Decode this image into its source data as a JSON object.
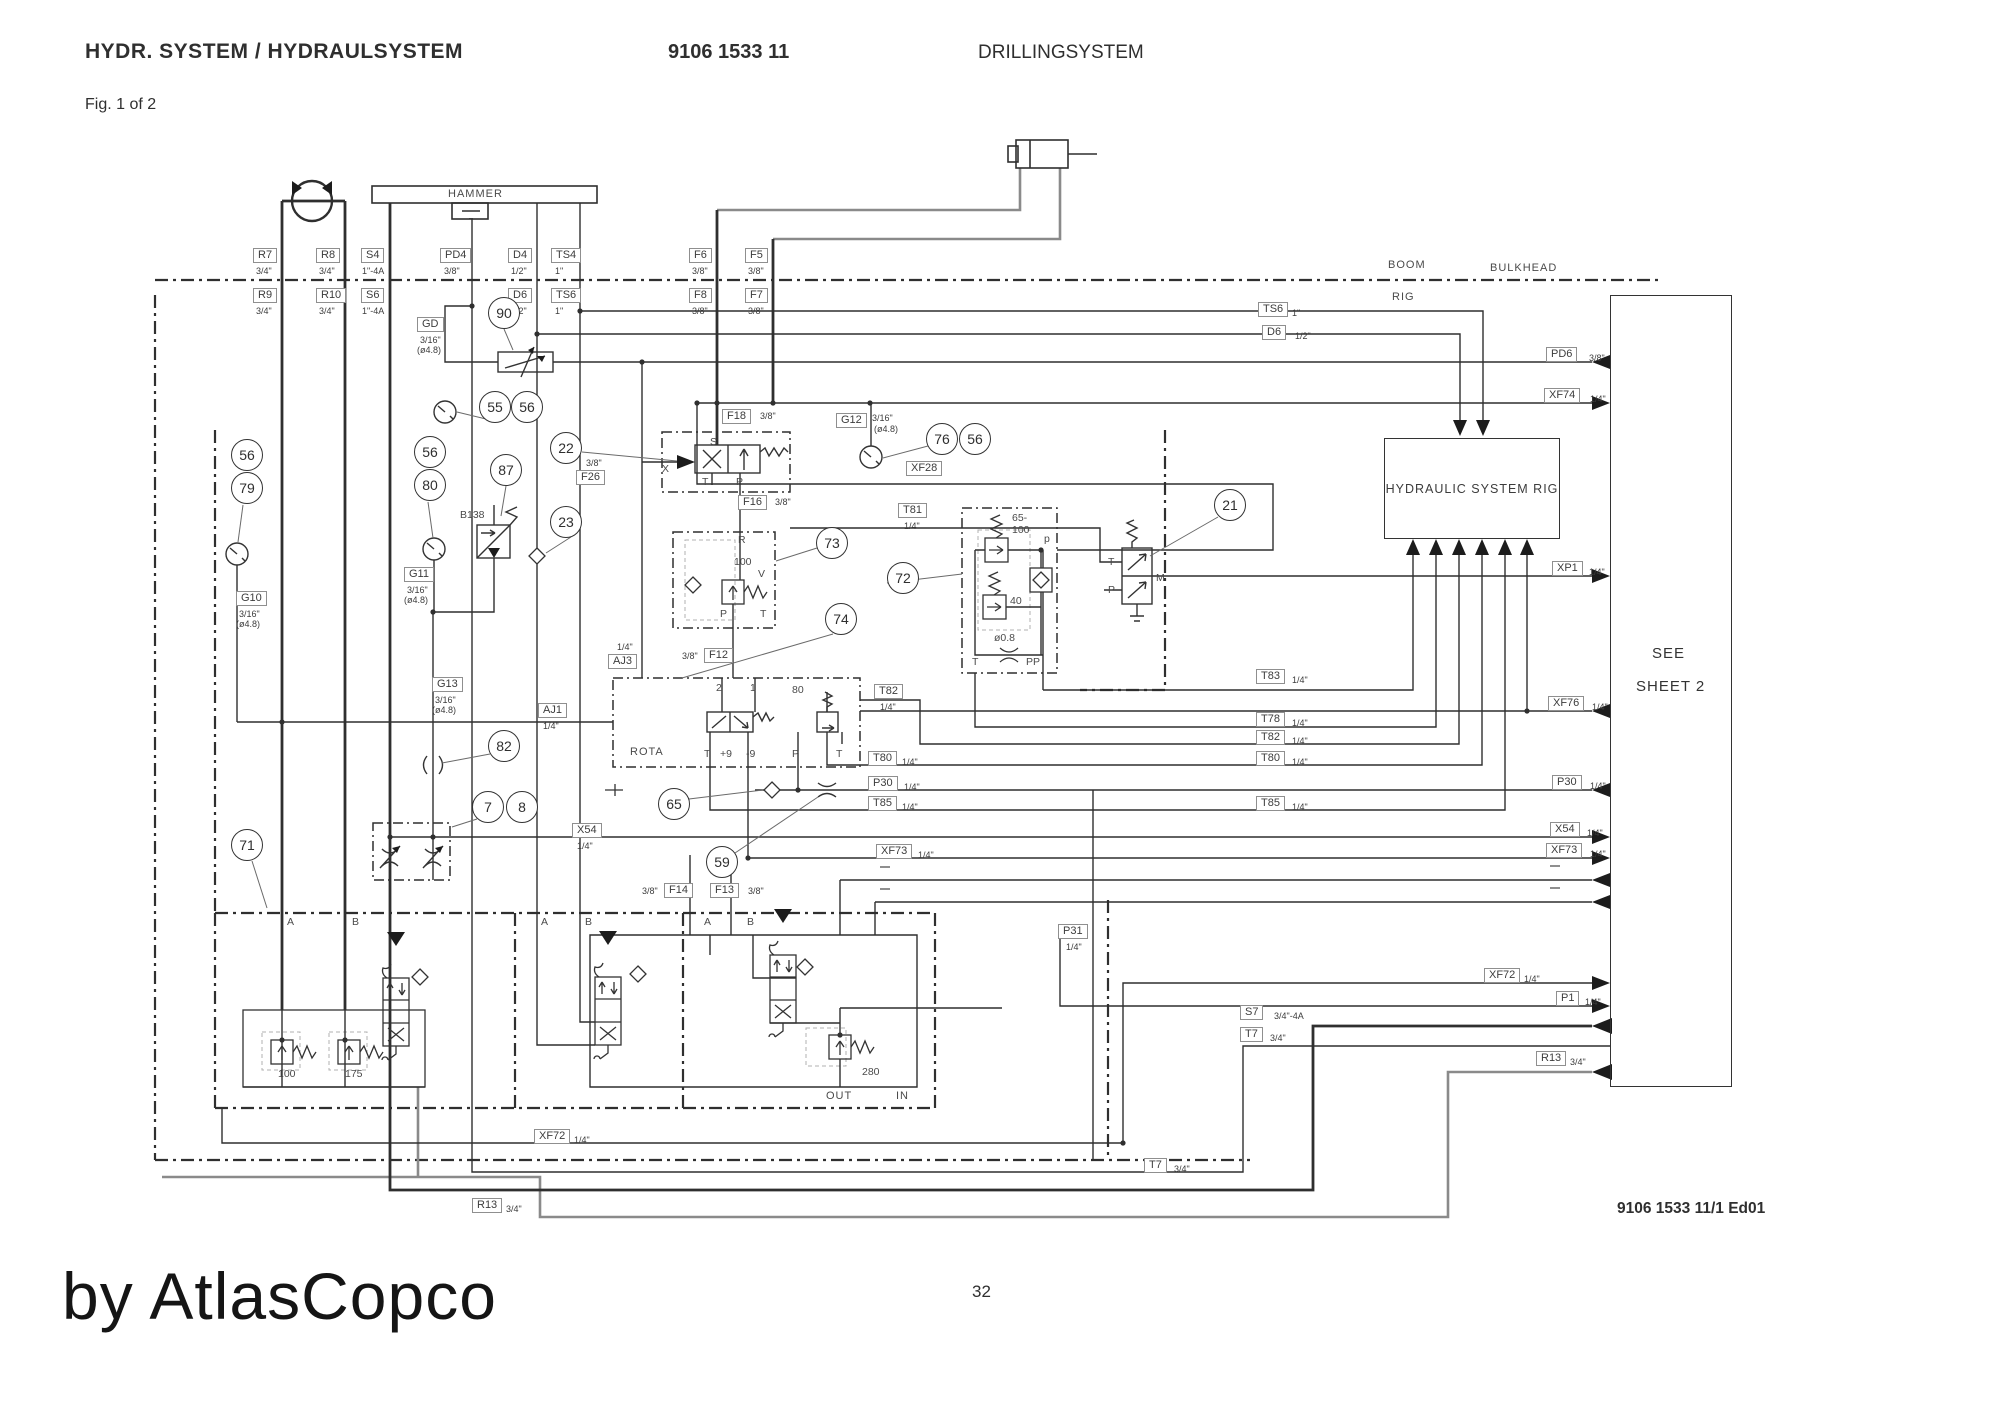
{
  "header": {
    "title": "HYDR. SYSTEM / HYDRAULSYSTEM",
    "doc_number": "9106 1533 11",
    "system": "DRILLINGSYSTEM",
    "figure": "Fig. 1 of 2"
  },
  "footer": {
    "page": "32",
    "edition": "9106 1533 11/1 Ed01",
    "watermark": "by AtlasCopco"
  },
  "zones": {
    "hammer": "HAMMER",
    "boom": "BOOM",
    "bulkhead": "BULKHEAD",
    "rig": "RIG",
    "rig_box": "HYDRAULIC SYSTEM RIG",
    "see": "SEE",
    "sheet2": "SHEET 2",
    "rota": "ROTA",
    "out": "OUT",
    "in": "IN"
  },
  "ports": {
    "r7": {
      "id": "R7",
      "size": "3/4\""
    },
    "r8": {
      "id": "R8",
      "size": "3/4\""
    },
    "r9": {
      "id": "R9",
      "size": "3/4\""
    },
    "r10": {
      "id": "R10",
      "size": "3/4\""
    },
    "s4": {
      "id": "S4",
      "size": "1\"-4A"
    },
    "s6": {
      "id": "S6",
      "size": "1\"-4A"
    },
    "s7": {
      "id": "S7",
      "size": "3/4\"-4A"
    },
    "pd4": {
      "id": "PD4",
      "size": "3/8\""
    },
    "pd6": {
      "id": "PD6",
      "size": "3/8\""
    },
    "d4": {
      "id": "D4",
      "size": "1/2\""
    },
    "d6": {
      "id": "D6",
      "size": "1/2\""
    },
    "ts4": {
      "id": "TS4",
      "size": "1\""
    },
    "ts6": {
      "id": "TS6",
      "size": "1\""
    },
    "f5": {
      "id": "F5",
      "size": "3/8\""
    },
    "f6": {
      "id": "F6",
      "size": "3/8\""
    },
    "f7": {
      "id": "F7",
      "size": "3/8\""
    },
    "f8": {
      "id": "F8",
      "size": "3/8\""
    },
    "f12": {
      "id": "F12",
      "size": "3/8\""
    },
    "f13": {
      "id": "F13",
      "size": "3/8\""
    },
    "f14": {
      "id": "F14",
      "size": "3/8\""
    },
    "f16": {
      "id": "F16",
      "size": "3/8\""
    },
    "f18": {
      "id": "F18",
      "size": "3/8\""
    },
    "f26": {
      "id": "F26",
      "size": "3/8\""
    },
    "gd": {
      "id": "GD",
      "size": "3/16\"",
      "drill": "(ø4.8)"
    },
    "g10": {
      "id": "G10",
      "size": "3/16\"",
      "drill": "(ø4.8)"
    },
    "g11": {
      "id": "G11",
      "size": "3/16\"",
      "drill": "(ø4.8)"
    },
    "g12": {
      "id": "G12",
      "size": "3/16\"",
      "drill": "(ø4.8)"
    },
    "g13": {
      "id": "G13",
      "size": "3/16\"",
      "drill": "(ø4.8)"
    },
    "aj1": {
      "id": "AJ1",
      "size": "1/4\""
    },
    "aj3": {
      "id": "AJ3",
      "size": "1/4\""
    },
    "t7": {
      "id": "T7",
      "size": "3/4\""
    },
    "t78": {
      "id": "T78",
      "size": "1/4\""
    },
    "t80": {
      "id": "T80",
      "size": "1/4\""
    },
    "t81": {
      "id": "T81",
      "size": "1/4\""
    },
    "t82": {
      "id": "T82",
      "size": "1/4\""
    },
    "t83": {
      "id": "T83",
      "size": "1/4\""
    },
    "t85": {
      "id": "T85",
      "size": "1/4\""
    },
    "p1": {
      "id": "P1",
      "size": "1/4\""
    },
    "p30": {
      "id": "P30",
      "size": "1/4\""
    },
    "p31": {
      "id": "P31",
      "size": "1/4\""
    },
    "r13": {
      "id": "R13",
      "size": "3/4\""
    },
    "x54": {
      "id": "X54",
      "size": "1/4\""
    },
    "xf28": {
      "id": "XF28",
      "size": ""
    },
    "xf72": {
      "id": "XF72",
      "size": "1/4\""
    },
    "xf73": {
      "id": "XF73",
      "size": "1/4\""
    },
    "xf74": {
      "id": "XF74",
      "size": "1/4\""
    },
    "xf76": {
      "id": "XF76",
      "size": "1/4\""
    },
    "xp1": {
      "id": "XP1",
      "size": "1/4\""
    }
  },
  "callouts": {
    "7": "7",
    "8": "8",
    "21": "21",
    "22": "22",
    "23": "23",
    "55": "55",
    "56": "56",
    "59": "59",
    "65": "65",
    "71": "71",
    "72": "72",
    "73": "73",
    "74": "74",
    "76": "76",
    "79": "79",
    "80": "80",
    "82": "82",
    "87": "87",
    "90": "90"
  },
  "values": {
    "b138": "B138",
    "v100": "100",
    "v175": "175",
    "v280": "280",
    "v80": "80",
    "v40": "40",
    "v65": "65-",
    "v65b": "100",
    "orifice": "ø0.8",
    "rv": "100"
  },
  "letters": {
    "a": "A",
    "b": "B",
    "p": "P",
    "t": "T",
    "s": "S",
    "x": "X",
    "r": "R",
    "v": "V",
    "m": "M",
    "pp": "PP",
    "psm": "p",
    "n1": "1",
    "n2": "2",
    "plus9": "+9",
    "minus9": "-9"
  }
}
